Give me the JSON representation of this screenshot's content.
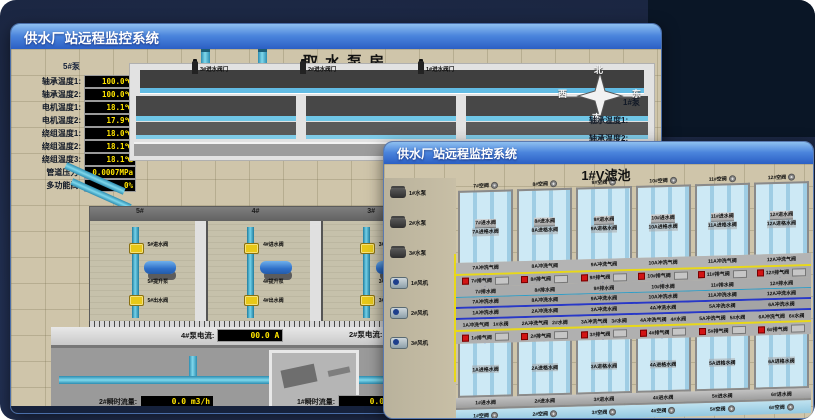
{
  "back_window": {
    "title": "供水厂站远程监控系统",
    "scene_title": "取水泵房",
    "pump_panel": {
      "pump_label": "5#泵",
      "readings": [
        {
          "label": "轴承温度1:",
          "value": "100.0℃"
        },
        {
          "label": "轴承温度2:",
          "value": "100.0℃"
        },
        {
          "label": "电机温度1:",
          "value": "18.1℃"
        },
        {
          "label": "电机温度2:",
          "value": "17.9℃"
        },
        {
          "label": "绕组温度1:",
          "value": "18.0℃"
        },
        {
          "label": "绕组温度2:",
          "value": "18.1℃"
        },
        {
          "label": "绕组温度3:",
          "value": "18.1℃"
        },
        {
          "label": "管道压力:",
          "value": "0.0007MPa"
        },
        {
          "label": "多功能阀:",
          "value": "0%"
        }
      ]
    },
    "compass": {
      "north": "北",
      "west": "西",
      "south": "南",
      "east": "东"
    },
    "right_pump_label": "1#泵",
    "right_captions": [
      "轴承温度1:",
      "轴承温度2:"
    ],
    "intake_valves": [
      "3#进水阀门",
      "2#进水阀门",
      "1#进水阀门"
    ],
    "pump_bays": [
      {
        "id": "5#",
        "valve_in": "5#进水阀",
        "pump": "5#提升泵",
        "valve_out": "5#出水阀"
      },
      {
        "id": "4#",
        "valve_in": "4#进水阀",
        "pump": "4#提升泵",
        "valve_out": "4#出水阀"
      },
      {
        "id": "3#",
        "valve_in": "3#进水阀",
        "pump": "3#提升泵",
        "valve_out": "3#出水阀"
      },
      {
        "id": "2#",
        "valve_in": "2#进水阀",
        "pump": "2#提升泵",
        "valve_out": "2#出水阀"
      },
      {
        "id": "1#",
        "valve_in": "1#进水阀",
        "pump": "1#提升泵",
        "valve_out": "1#出水阀"
      }
    ],
    "current_left": {
      "label": "4#泵电流:",
      "value": "00.0 A"
    },
    "current_right": {
      "label": "2#泵电流:",
      "value": ""
    },
    "flow_left": {
      "label": "2#瞬时流量:",
      "value": "0.0 m3/h"
    },
    "flow_right": {
      "label": "1#瞬时流量:",
      "value": "0.0 m3/h"
    }
  },
  "front_window": {
    "title": "供水厂站远程监控系统",
    "scene_title": "1#V滤池",
    "pumps": [
      "1#水泵",
      "2#水泵",
      "3#水泵"
    ],
    "blowers": [
      "1#风机",
      "2#风机",
      "3#风机"
    ],
    "top_cells": [
      {
        "air": "7#空阀",
        "inlet": "7#进水阀",
        "grid": "7A进格水阀"
      },
      {
        "air": "8#空阀",
        "inlet": "8#进水阀",
        "grid": "8A进格水阀"
      },
      {
        "air": "9#空阀",
        "inlet": "9#进水阀",
        "grid": "9A进格水阀"
      },
      {
        "air": "10#空阀",
        "inlet": "10#进水阀",
        "grid": "10A进格水阀"
      },
      {
        "air": "11#空阀",
        "inlet": "11#进水阀",
        "grid": "11A进格水阀"
      },
      {
        "air": "12#空阀",
        "inlet": "12#进水阀",
        "grid": "12A进格水阀"
      }
    ],
    "gallery": {
      "top_wash_air": [
        "7A冲洗气阀",
        "8A冲洗气阀",
        "9A冲洗气阀",
        "10A冲洗气阀",
        "11A冲洗气阀",
        "12A冲洗气阀"
      ],
      "top_vent": [
        "7#排气阀",
        "8#排气阀",
        "9#排气阀",
        "10#排气阀",
        "11#排气阀",
        "12#排气阀"
      ],
      "top_drain": [
        "7#排水阀",
        "8#排水阀",
        "9#排水阀",
        "10#排水阀",
        "11#排水阀",
        "12#排水阀"
      ],
      "top_wash_water": [
        "7A冲洗水阀",
        "8A冲洗水阀",
        "9A冲洗水阀",
        "10A冲洗水阀",
        "11A冲洗水阀",
        "12A冲洗水阀"
      ],
      "bottom_wash_water": [
        "1A冲洗水阀",
        "2A冲洗水阀",
        "3A冲洗水阀",
        "4A冲洗水阀",
        "5A冲洗水阀",
        "6A冲洗水阀"
      ],
      "bottom_pairs": [
        {
          "wash": "1A冲洗气阀",
          "valve": "1#水阀"
        },
        {
          "wash": "2A冲洗气阀",
          "valve": "2#水阀"
        },
        {
          "wash": "3A冲洗气阀",
          "valve": "3#水阀"
        },
        {
          "wash": "4A冲洗气阀",
          "valve": "4#水阀"
        },
        {
          "wash": "5A冲洗气阀",
          "valve": "5#水阀"
        },
        {
          "wash": "6A冲洗气阀",
          "valve": "6#水阀"
        }
      ],
      "bottom_vent": [
        "1#排气阀",
        "2#排气阀",
        "3#排气阀",
        "4#排气阀",
        "5#排气阀",
        "6#排气阀"
      ]
    },
    "bottom_cells": [
      {
        "grid": "1A进格水阀",
        "inlet": "1#进水阀",
        "air": "1#空阀"
      },
      {
        "grid": "2A进格水阀",
        "inlet": "2#进水阀",
        "air": "2#空阀"
      },
      {
        "grid": "3A进格水阀",
        "inlet": "3#进水阀",
        "air": "3#空阀"
      },
      {
        "grid": "4A进格水阀",
        "inlet": "4#进水阀",
        "air": "4#空阀"
      },
      {
        "grid": "5A进格水阀",
        "inlet": "5#进水阀",
        "air": "5#空阀"
      },
      {
        "grid": "6A进格水阀",
        "inlet": "6#进水阀",
        "air": "6#空阀"
      }
    ]
  }
}
